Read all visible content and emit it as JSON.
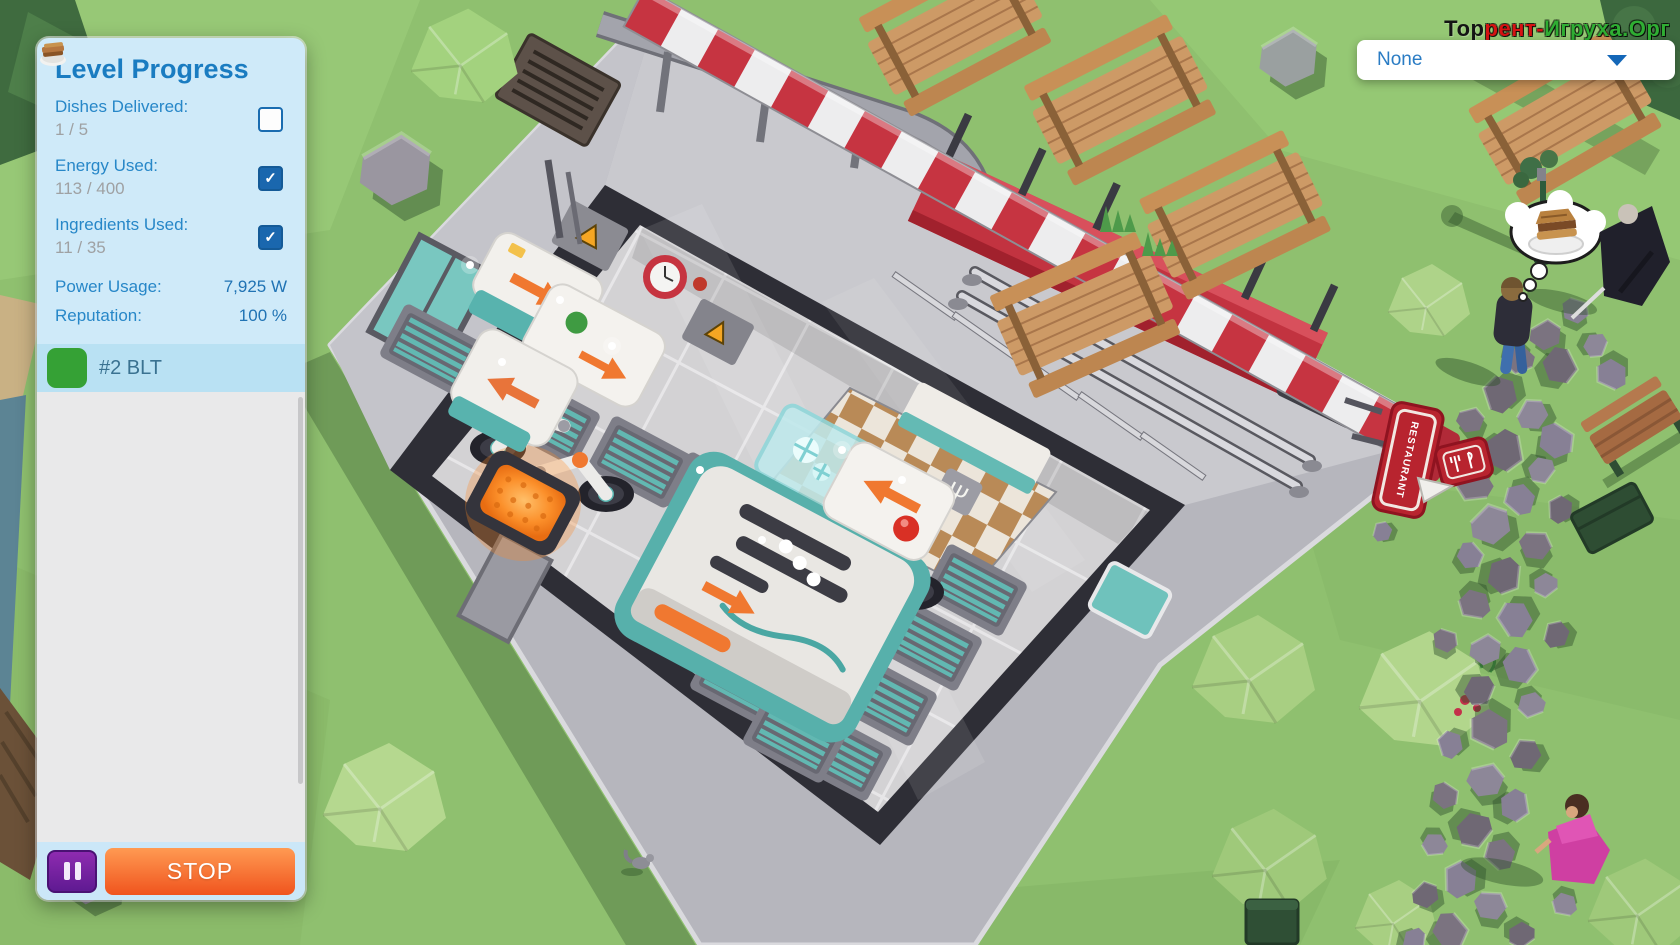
{
  "watermark": {
    "part1": "Тор",
    "part2": "рент-",
    "part3": "Игруха.Орг"
  },
  "hud": {
    "dropdown": {
      "value": "None",
      "caret_icon": "chevron-down-icon"
    },
    "panel": {
      "title": "Level Progress",
      "stats": [
        {
          "label": "Dishes Delivered:",
          "value": "1 / 5",
          "checked": false
        },
        {
          "label": "Energy Used:",
          "value": "113 / 400",
          "checked": true
        },
        {
          "label": "Ingredients Used:",
          "value": "11 / 35",
          "checked": true
        }
      ],
      "check_glyph": "✓",
      "metrics": [
        {
          "label": "Power Usage:",
          "value": "7,925 W"
        },
        {
          "label": "Reputation:",
          "value": "100 %"
        }
      ],
      "orders": [
        {
          "label": "#2 BLT",
          "icon": "blt-sandwich-icon"
        }
      ],
      "stop_label": "STOP"
    }
  },
  "scene": {
    "restaurant_sign_text": "RESTAURANT",
    "cutlery_floor_glyph": "Ψ"
  },
  "colors": {
    "panel_bg": "#cfeaf9",
    "title_blue": "#1a7cc1",
    "label_blue": "#2787c8",
    "value_gray": "#9fa1a3",
    "checkbox_blue": "#1a67ae",
    "order_row_bg": "#b9e1f3",
    "order_icon_green": "#35a135",
    "stop_orange": "#f0541e",
    "pause_purple": "#6a1b9a",
    "grass_green": "#8fc06f",
    "awning_red": "#c63441",
    "sign_red": "#b8242f",
    "belt_teal": "#62b8b2",
    "glow_orange": "#ff8c2e"
  }
}
